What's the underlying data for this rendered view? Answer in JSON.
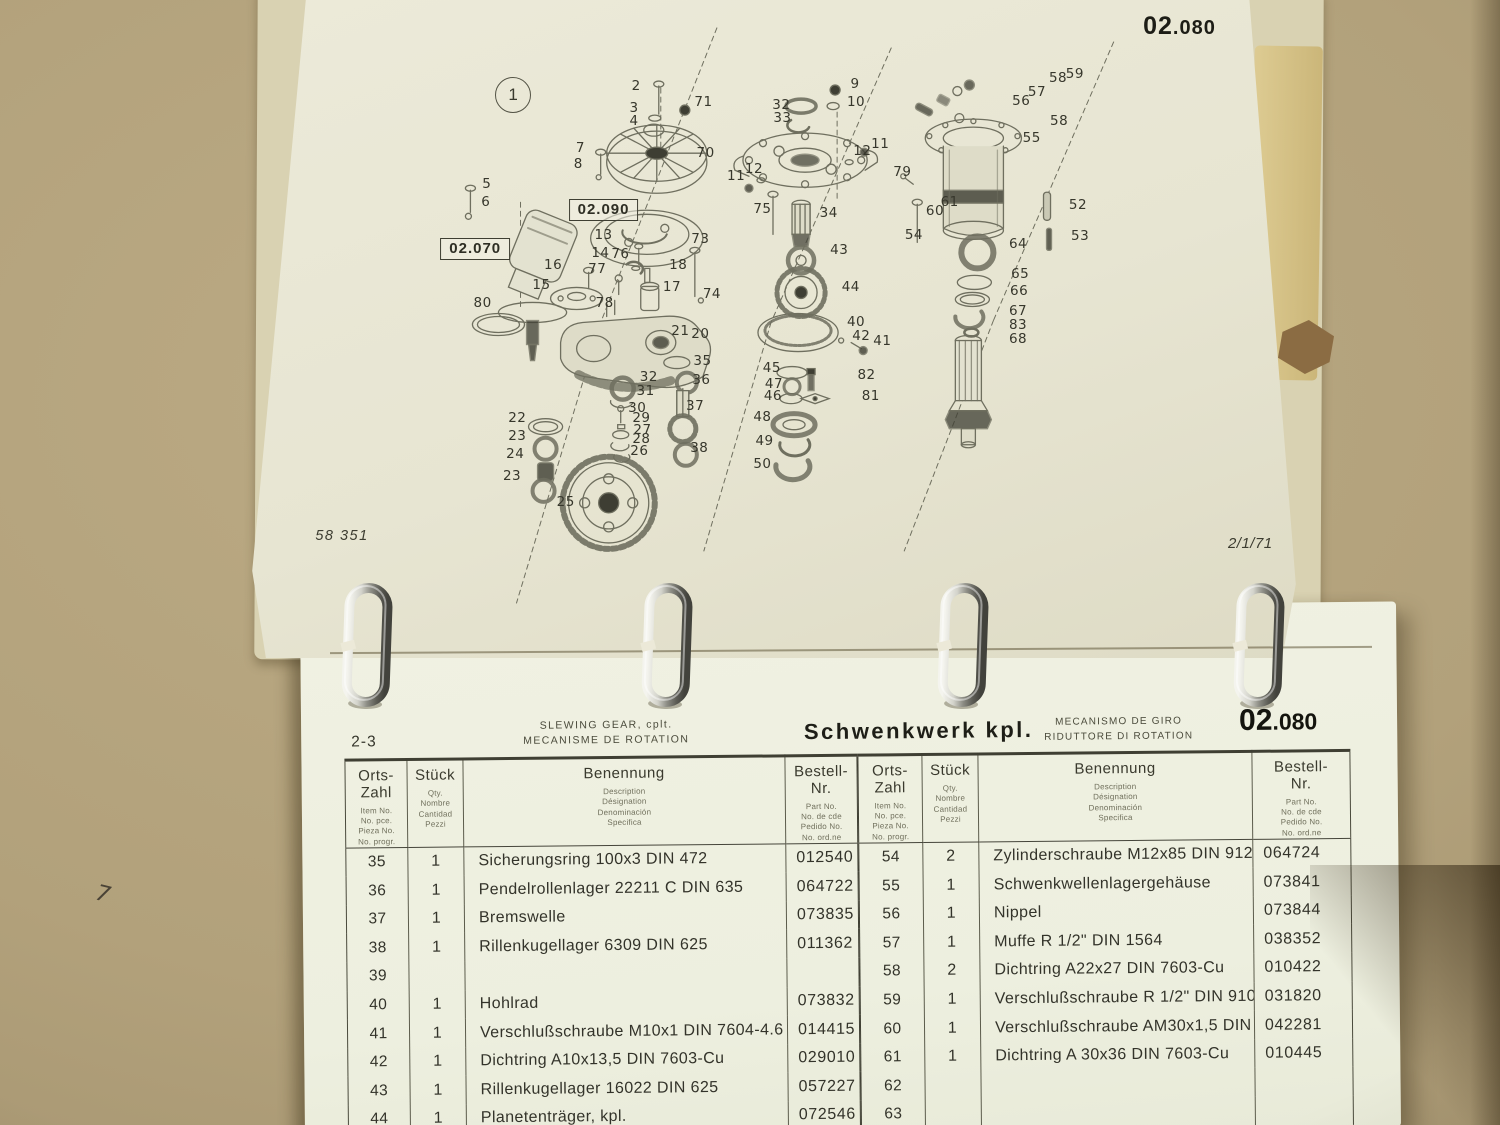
{
  "photo": {
    "handwritten_mark": "7"
  },
  "top_page": {
    "code_prefix": "02",
    "code_suffix": ".080",
    "figure_label": "1",
    "ref_box_1": "02.090",
    "ref_box_2": "02.070",
    "doc_number": "58 351",
    "revision_date": "2/1/71",
    "callouts": [
      {
        "n": "2",
        "x": 36.9,
        "y": 14.7
      },
      {
        "n": "3",
        "x": 36.7,
        "y": 17.9
      },
      {
        "n": "4",
        "x": 36.7,
        "y": 19.8
      },
      {
        "n": "71",
        "x": 43.3,
        "y": 17.0
      },
      {
        "n": "7",
        "x": 31.6,
        "y": 23.9
      },
      {
        "n": "8",
        "x": 31.4,
        "y": 26.2
      },
      {
        "n": "70",
        "x": 43.5,
        "y": 24.7
      },
      {
        "n": "5",
        "x": 22.7,
        "y": 29.2
      },
      {
        "n": "6",
        "x": 22.6,
        "y": 32.0
      },
      {
        "n": "13",
        "x": 33.8,
        "y": 36.8
      },
      {
        "n": "14",
        "x": 33.5,
        "y": 39.5
      },
      {
        "n": "16",
        "x": 29.0,
        "y": 41.4
      },
      {
        "n": "76",
        "x": 35.4,
        "y": 39.7
      },
      {
        "n": "77",
        "x": 33.2,
        "y": 42.0
      },
      {
        "n": "73",
        "x": 43.0,
        "y": 37.4
      },
      {
        "n": "18",
        "x": 40.9,
        "y": 41.4
      },
      {
        "n": "15",
        "x": 27.9,
        "y": 44.4
      },
      {
        "n": "17",
        "x": 40.3,
        "y": 44.7
      },
      {
        "n": "74",
        "x": 44.1,
        "y": 45.6
      },
      {
        "n": "80",
        "x": 22.3,
        "y": 47.0
      },
      {
        "n": "78",
        "x": 33.9,
        "y": 47.0
      },
      {
        "n": "9",
        "x": 57.7,
        "y": 14.4
      },
      {
        "n": "10",
        "x": 57.8,
        "y": 17.0
      },
      {
        "n": "32",
        "x": 50.7,
        "y": 17.4
      },
      {
        "n": "33",
        "x": 50.8,
        "y": 19.4
      },
      {
        "n": "11",
        "x": 60.1,
        "y": 23.3
      },
      {
        "n": "12",
        "x": 58.4,
        "y": 24.4
      },
      {
        "n": "12",
        "x": 48.1,
        "y": 27.0
      },
      {
        "n": "11",
        "x": 46.4,
        "y": 28.0
      },
      {
        "n": "75",
        "x": 48.9,
        "y": 33.0
      },
      {
        "n": "34",
        "x": 55.2,
        "y": 33.6
      },
      {
        "n": "43",
        "x": 56.2,
        "y": 39.1
      },
      {
        "n": "44",
        "x": 57.3,
        "y": 44.7
      },
      {
        "n": "79",
        "x": 62.2,
        "y": 27.4
      },
      {
        "n": "61",
        "x": 66.7,
        "y": 32.0
      },
      {
        "n": "60",
        "x": 65.3,
        "y": 33.3
      },
      {
        "n": "54",
        "x": 63.3,
        "y": 36.8
      },
      {
        "n": "56",
        "x": 73.5,
        "y": 16.8
      },
      {
        "n": "57",
        "x": 75.0,
        "y": 15.5
      },
      {
        "n": "58",
        "x": 77.0,
        "y": 13.5
      },
      {
        "n": "59",
        "x": 78.6,
        "y": 12.9
      },
      {
        "n": "58",
        "x": 77.1,
        "y": 19.8
      },
      {
        "n": "55",
        "x": 74.5,
        "y": 22.4
      },
      {
        "n": "52",
        "x": 78.9,
        "y": 32.4
      },
      {
        "n": "53",
        "x": 79.1,
        "y": 37.0
      },
      {
        "n": "64",
        "x": 73.2,
        "y": 38.2
      },
      {
        "n": "65",
        "x": 73.4,
        "y": 42.7
      },
      {
        "n": "66",
        "x": 73.3,
        "y": 45.2
      },
      {
        "n": "67",
        "x": 73.2,
        "y": 48.2
      },
      {
        "n": "83",
        "x": 73.2,
        "y": 50.3
      },
      {
        "n": "68",
        "x": 73.2,
        "y": 52.4
      },
      {
        "n": "21",
        "x": 41.1,
        "y": 51.2
      },
      {
        "n": "20",
        "x": 43.0,
        "y": 51.7
      },
      {
        "n": "35",
        "x": 43.2,
        "y": 55.6
      },
      {
        "n": "32",
        "x": 38.1,
        "y": 58.0
      },
      {
        "n": "36",
        "x": 43.1,
        "y": 58.5
      },
      {
        "n": "31",
        "x": 37.8,
        "y": 60.2
      },
      {
        "n": "37",
        "x": 42.5,
        "y": 62.4
      },
      {
        "n": "30",
        "x": 37.0,
        "y": 62.7
      },
      {
        "n": "29",
        "x": 37.4,
        "y": 64.2
      },
      {
        "n": "27",
        "x": 37.5,
        "y": 65.9
      },
      {
        "n": "28",
        "x": 37.4,
        "y": 67.3
      },
      {
        "n": "26",
        "x": 37.2,
        "y": 69.1
      },
      {
        "n": "38",
        "x": 42.9,
        "y": 68.6
      },
      {
        "n": "22",
        "x": 25.6,
        "y": 64.2
      },
      {
        "n": "23",
        "x": 25.6,
        "y": 66.8
      },
      {
        "n": "24",
        "x": 25.4,
        "y": 69.5
      },
      {
        "n": "23",
        "x": 25.1,
        "y": 72.9
      },
      {
        "n": "25",
        "x": 30.2,
        "y": 76.7
      },
      {
        "n": "40",
        "x": 57.8,
        "y": 49.8
      },
      {
        "n": "42",
        "x": 58.3,
        "y": 52.0
      },
      {
        "n": "41",
        "x": 60.3,
        "y": 52.7
      },
      {
        "n": "45",
        "x": 49.8,
        "y": 56.7
      },
      {
        "n": "82",
        "x": 58.8,
        "y": 57.7
      },
      {
        "n": "47",
        "x": 50.0,
        "y": 59.1
      },
      {
        "n": "46",
        "x": 49.9,
        "y": 60.9
      },
      {
        "n": "81",
        "x": 59.2,
        "y": 60.9
      },
      {
        "n": "48",
        "x": 48.9,
        "y": 64.1
      },
      {
        "n": "49",
        "x": 49.1,
        "y": 67.6
      },
      {
        "n": "50",
        "x": 48.9,
        "y": 71.1
      }
    ]
  },
  "parts_list": {
    "sheet_ref": "2-3",
    "title_en": "SLEWING GEAR, cplt.",
    "title_fr": "MECANISME DE ROTATION",
    "title_de": "Schwenkwerk kpl.",
    "title_es": "MECANISMO DE GIRO",
    "title_it": "RIDUTTORE DI ROTATION",
    "code_prefix": "02",
    "code_suffix": ".080",
    "columns": {
      "item": {
        "l1": "Orts-",
        "l2": "Zahl",
        "sub": [
          "Item No.",
          "No. pce.",
          "Pieza No.",
          "No. progr."
        ]
      },
      "qty": {
        "label": "Stück",
        "sub": [
          "Qty.",
          "Nombre",
          "Cantidad",
          "Pezzi"
        ]
      },
      "name": {
        "label": "Benennung",
        "sub": [
          "Description",
          "Désignation",
          "Denominación",
          "Specifica"
        ]
      },
      "order": {
        "l1": "Bestell-",
        "l2": "Nr.",
        "sub": [
          "Part No.",
          "No. de cde",
          "Pedido No.",
          "No. ord.ne"
        ]
      }
    },
    "left_rows": [
      {
        "item": "35",
        "qty": "1",
        "name": "Sicherungsring 100x3   DIN 472",
        "no": "012540"
      },
      {
        "item": "36",
        "qty": "1",
        "name": "Pendelrollenlager 22211 C   DIN 635",
        "no": "064722"
      },
      {
        "item": "37",
        "qty": "1",
        "name": "Bremswelle",
        "no": "073835"
      },
      {
        "item": "38",
        "qty": "1",
        "name": "Rillenkugellager 6309   DIN 625",
        "no": "011362"
      },
      {
        "item": "39",
        "qty": "",
        "name": "",
        "no": ""
      },
      {
        "item": "40",
        "qty": "1",
        "name": "Hohlrad",
        "no": "073832"
      },
      {
        "item": "41",
        "qty": "1",
        "name": "Verschlußschraube M10x1   DIN 7604-4.6",
        "no": "014415"
      },
      {
        "item": "42",
        "qty": "1",
        "name": "Dichtring A10x13,5   DIN 7603-Cu",
        "no": "029010"
      },
      {
        "item": "43",
        "qty": "1",
        "name": "Rillenkugellager 16022  DIN 625",
        "no": "057227"
      },
      {
        "item": "44",
        "qty": "1",
        "name": "Planetenträger,  kpl.",
        "no": "072546"
      }
    ],
    "right_rows": [
      {
        "item": "54",
        "qty": "2",
        "name": "Zylinderschraube M12x85   DIN 912-8.8",
        "no": "064724"
      },
      {
        "item": "55",
        "qty": "1",
        "name": "Schwenkwellenlagergehäuse",
        "no": "073841"
      },
      {
        "item": "56",
        "qty": "1",
        "name": "Nippel",
        "no": "073844"
      },
      {
        "item": "57",
        "qty": "1",
        "name": "Muffe R 1/2\"   DIN 1564",
        "no": "038352"
      },
      {
        "item": "58",
        "qty": "2",
        "name": "Dichtring A22x27   DIN 7603-Cu",
        "no": "010422"
      },
      {
        "item": "59",
        "qty": "1",
        "name": "Verschlußschraube R 1/2\"   DIN 910-4.6",
        "no": "031820"
      },
      {
        "item": "60",
        "qty": "1",
        "name": "Verschlußschraube AM30x1,5   DIN 7604-4.6",
        "no": "042281"
      },
      {
        "item": "61",
        "qty": "1",
        "name": "Dichtring A 30x36   DIN 7603-Cu",
        "no": "010445"
      },
      {
        "item": "62",
        "qty": "",
        "name": "",
        "no": ""
      },
      {
        "item": "63",
        "qty": "",
        "name": "",
        "no": ""
      }
    ]
  }
}
